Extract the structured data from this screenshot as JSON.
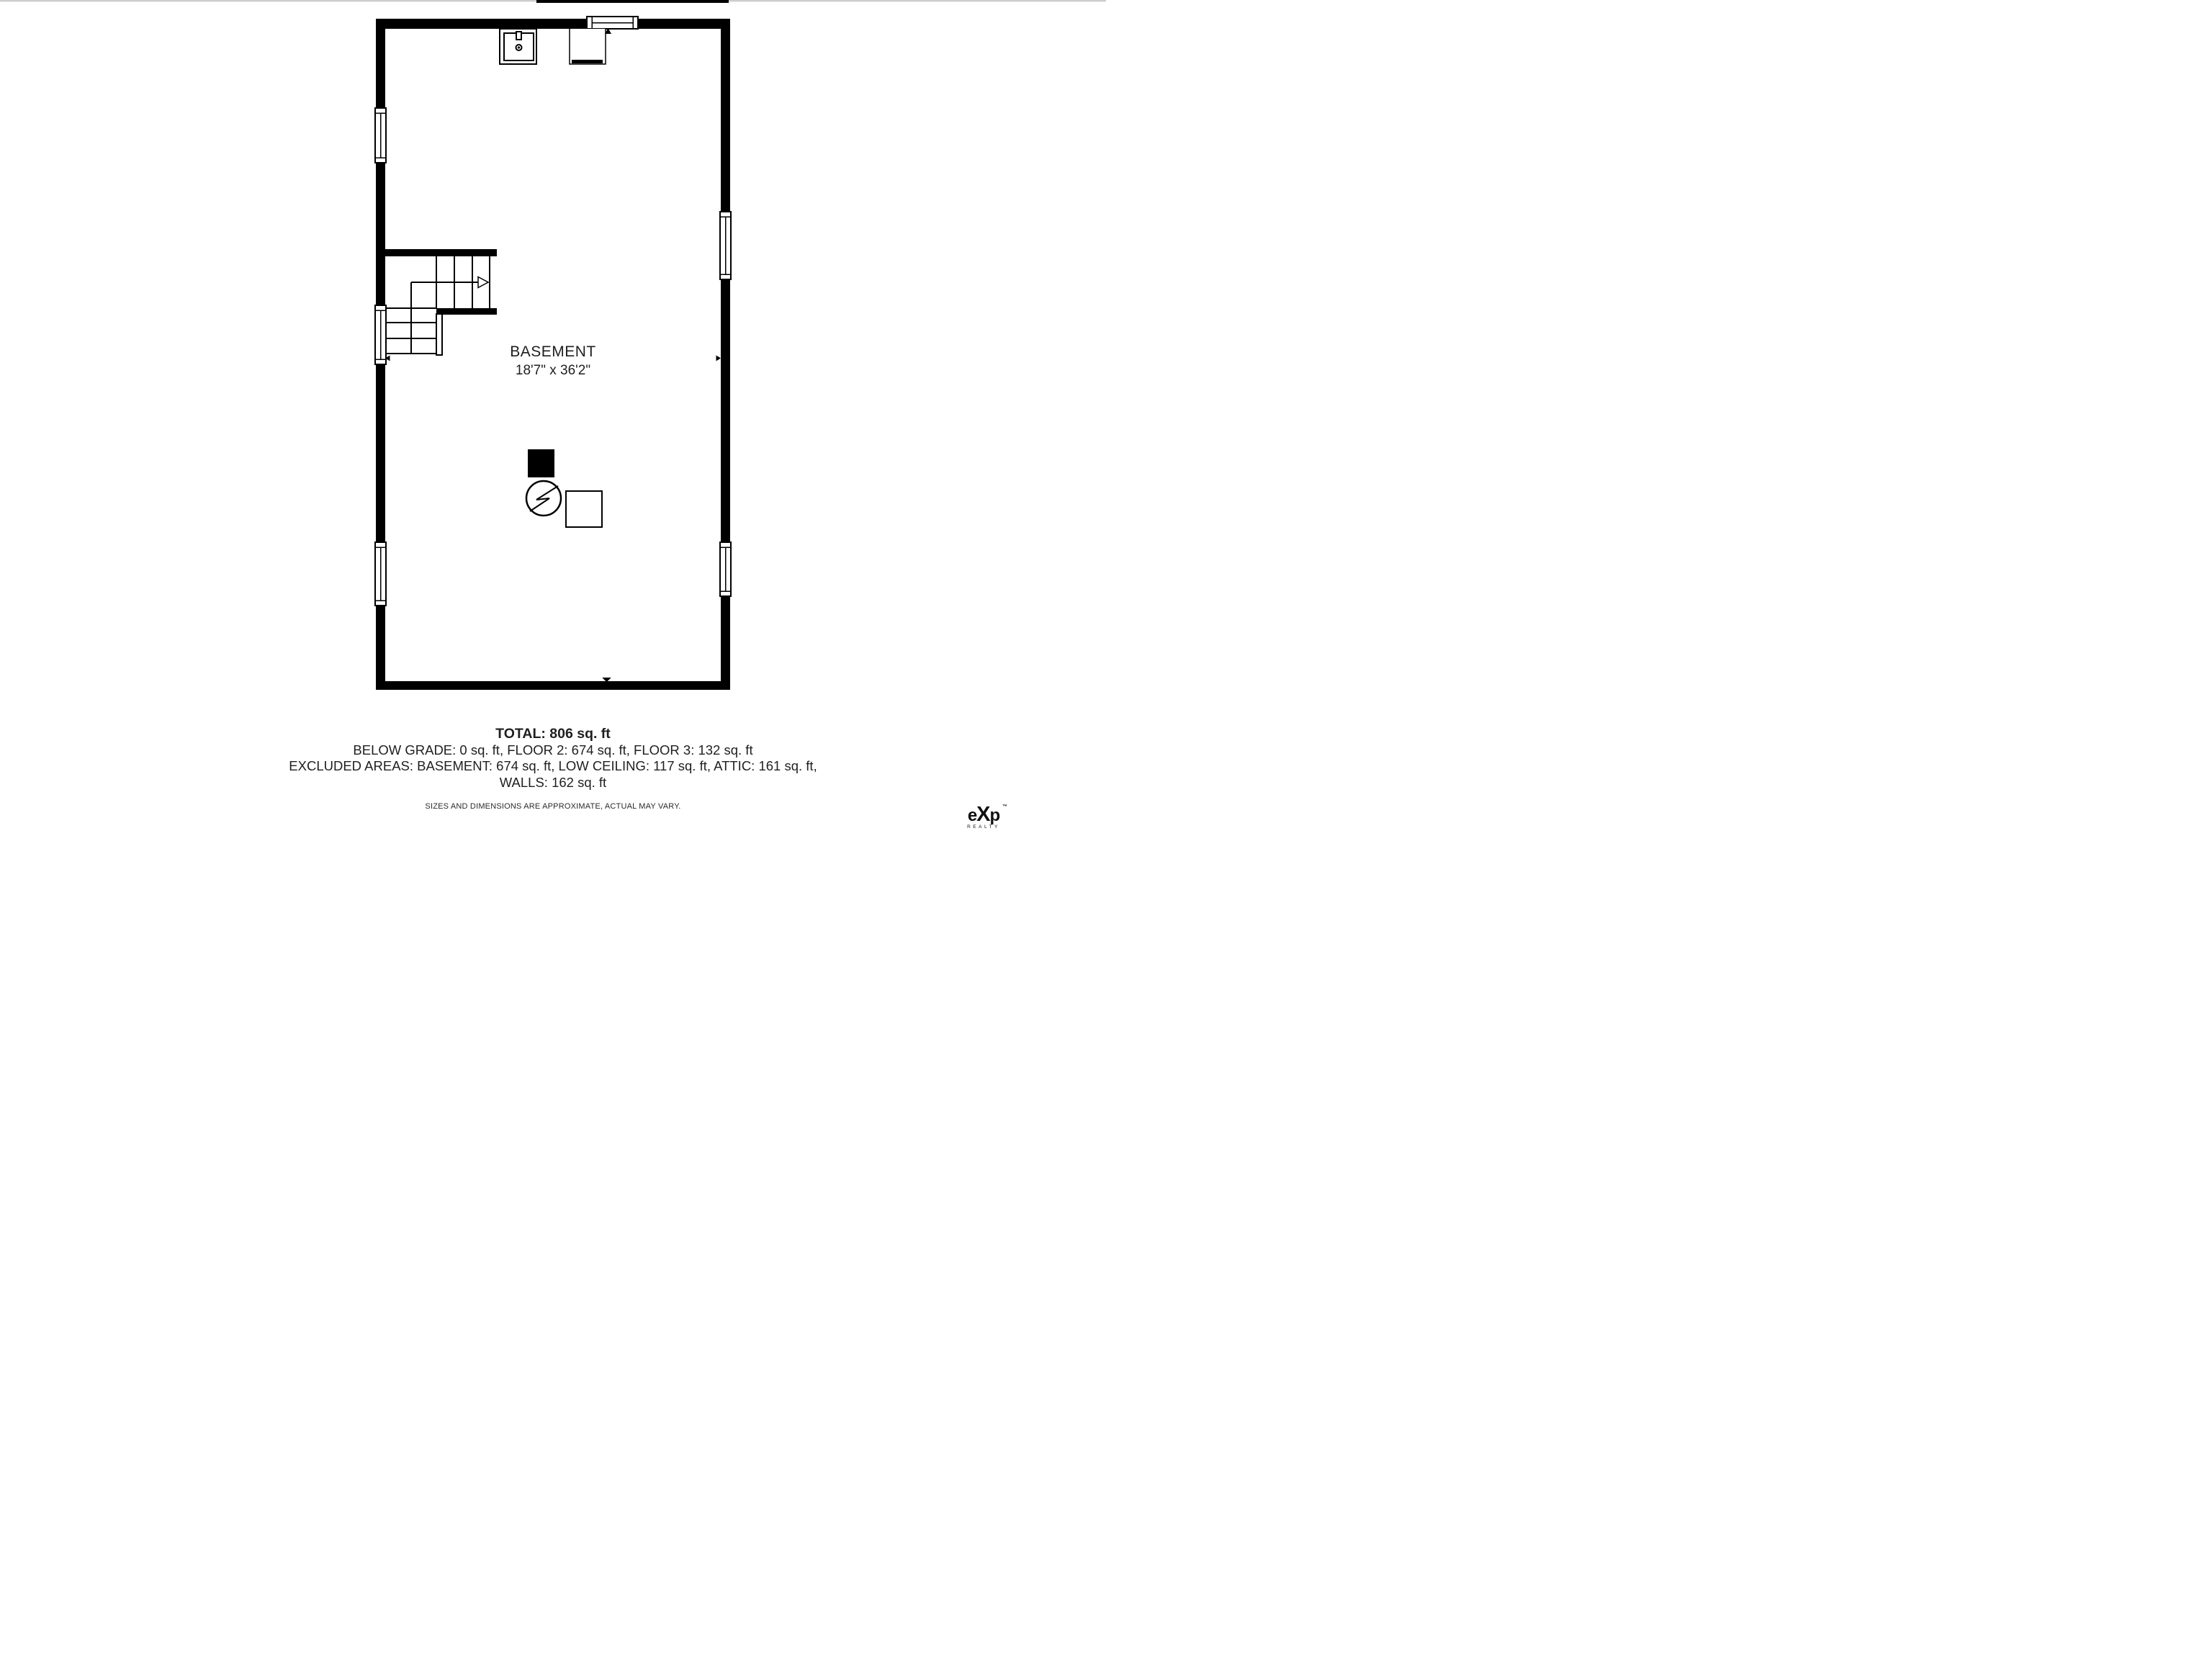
{
  "plan": {
    "room_label": "BASEMENT",
    "room_dimensions": "18'7\" x 36'2\""
  },
  "summary": {
    "total": "TOTAL: 806 sq. ft",
    "breakdown_line_1": "BELOW GRADE: 0 sq. ft, FLOOR 2: 674 sq. ft, FLOOR 3: 132 sq. ft",
    "breakdown_line_2": "EXCLUDED AREAS: BASEMENT: 674 sq. ft, LOW CEILING: 117 sq. ft, ATTIC: 161 sq. ft,",
    "breakdown_line_3": "WALLS: 162 sq. ft"
  },
  "disclaimer": "SIZES AND DIMENSIONS ARE APPROXIMATE, ACTUAL MAY VARY.",
  "brand": {
    "letter_e": "e",
    "letter_x": "X",
    "letter_p": "p",
    "sub": "REALTY",
    "tm": "™"
  },
  "colors": {
    "wall": "#000000",
    "background": "#ffffff",
    "text": "#1f1f1f",
    "top_edge_line": "#b5b5b5"
  }
}
